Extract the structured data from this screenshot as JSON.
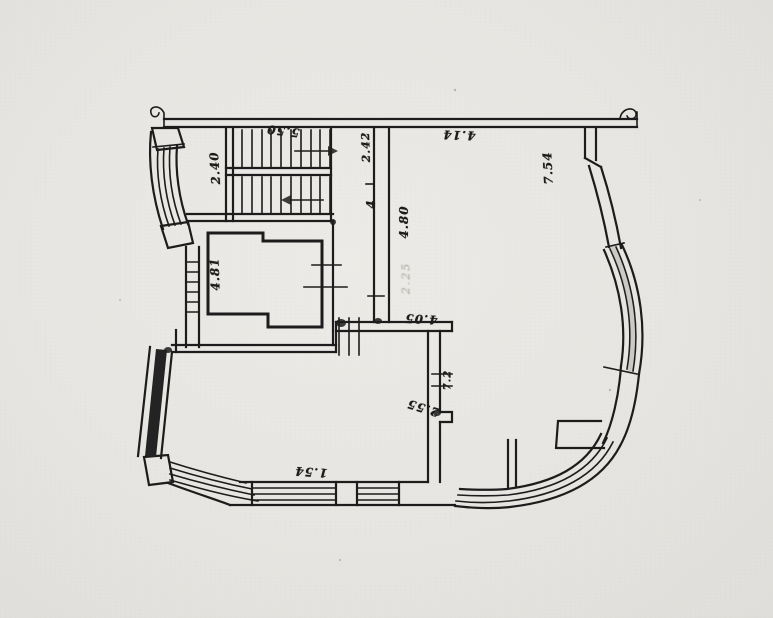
{
  "figure": {
    "type": "architectural-floor-plan",
    "style": "scanned ink drawing on aged paper, handwritten rotated dimension labels"
  },
  "palette": {
    "paper": "#e8e6e2",
    "ink": "#1c1c1c",
    "pencil": "#a3a099"
  },
  "labels": {
    "stair_top": "5.50",
    "stair_left": "2.40",
    "top_width": "4.14",
    "right_height": "7.54",
    "corridor_left": "2.42",
    "corridor_mid": "4",
    "corridor_right": "4.80",
    "pencil_note": "2.25",
    "mid_wall": "4.05",
    "lower_jamb": "7.2",
    "lower_diag": "2.55",
    "bottom_width": "1.54",
    "room_left": "4.81"
  },
  "plan_features": [
    "double-flight staircase top-left with direction arrows",
    "curved window bay on left facade",
    "small room with notched corners (shaft) left-center",
    "central corridor walls",
    "large room right with curved curtain-wall band",
    "bottom wall with two window openings",
    "curved glazing band sweeping around bottom-right corner",
    "slanted hatched wall bottom-left"
  ]
}
